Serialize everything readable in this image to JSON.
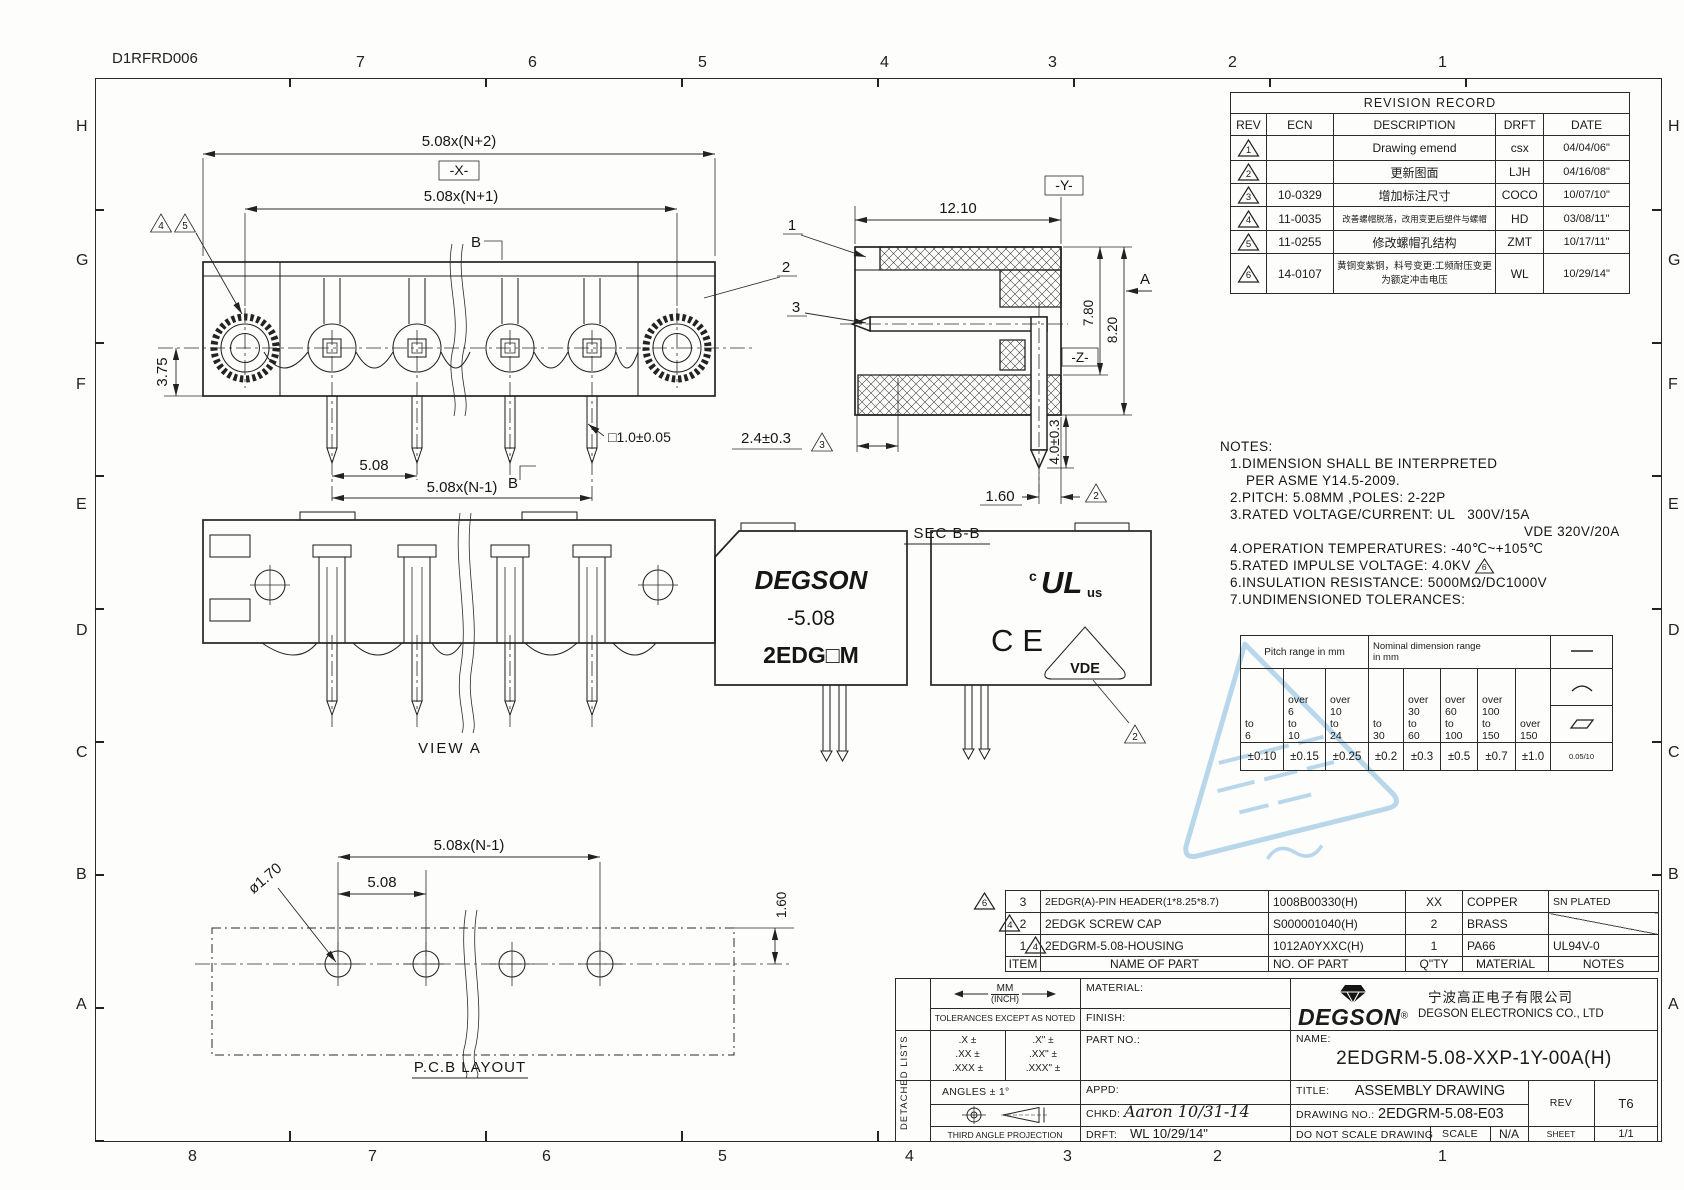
{
  "doc_code": "D1RFRD006",
  "grid": {
    "top": [
      "7",
      "6",
      "5",
      "4",
      "3",
      "2",
      "1"
    ],
    "bottom": [
      "8",
      "7",
      "6",
      "5",
      "4",
      "3",
      "2",
      "1"
    ],
    "left": [
      "H",
      "G",
      "F",
      "E",
      "D",
      "C",
      "B",
      "A"
    ],
    "right": [
      "H",
      "G",
      "F",
      "E",
      "D",
      "C",
      "B",
      "A"
    ]
  },
  "revision_table": {
    "title": "REVISION RECORD",
    "headers": {
      "rev": "REV",
      "ecn": "ECN",
      "description": "DESCRIPTION",
      "drft": "DRFT",
      "date": "DATE"
    },
    "rows": [
      {
        "rev": "1",
        "ecn": "",
        "desc": "Drawing emend",
        "drft": "csx",
        "date": "04/04/06\""
      },
      {
        "rev": "2",
        "ecn": "",
        "desc": "更新图面",
        "drft": "LJH",
        "date": "04/16/08\""
      },
      {
        "rev": "3",
        "ecn": "10-0329",
        "desc": "增加标注尺寸",
        "drft": "COCO",
        "date": "10/07/10\""
      },
      {
        "rev": "4",
        "ecn": "11-0035",
        "desc": "改善螺帽脱落，改用变更后塑件与螺帽",
        "drft": "HD",
        "date": "03/08/11\""
      },
      {
        "rev": "5",
        "ecn": "11-0255",
        "desc": "修改螺帽孔结构",
        "drft": "ZMT",
        "date": "10/17/11\""
      },
      {
        "rev": "6",
        "ecn": "14-0107",
        "desc": "黄铜变紫铜，料号变更:工频耐压变更为额定冲击电压",
        "drft": "WL",
        "date": "10/29/14\""
      }
    ]
  },
  "notes": {
    "title": "NOTES:",
    "line1": "1.DIMENSION SHALL BE INTERPRETED",
    "line1b": "PER ASME Y14.5-2009.",
    "line2": "2.PITCH: 5.08MM ,POLES: 2-22P",
    "line3": "3.RATED VOLTAGE/CURRENT: UL   300V/15A",
    "line3b": "VDE 320V/20A",
    "line4": "4.OPERATION TEMPERATURES: -40℃~+105℃",
    "line5": "5.RATED IMPULSE VOLTAGE: 4.0KV",
    "line5_flag": "6",
    "line6": "6.INSULATION RESISTANCE: 5000MΩ/DC1000V",
    "line7": "7.UNDIMENSIONED TOLERANCES:"
  },
  "tolerance_table": {
    "pitch_header": "Pitch range in mm",
    "nominal_header": "Nominal dimension range\nin mm",
    "ranges": [
      "to\n6",
      "over\n6\nto\n10",
      "over\n10\nto\n24",
      "to\n30",
      "over\n30\nto\n60",
      "over\n60\nto\n100",
      "over\n100\nto\n150",
      "over\n150"
    ],
    "values": [
      "±0.10",
      "±0.15",
      "±0.25",
      "±0.2",
      "±0.3",
      "±0.5",
      "±0.7",
      "±1.0"
    ],
    "flatness": "0.05/10",
    "symbols": [
      "straightness-line",
      "arc",
      "parallelogram"
    ]
  },
  "bom": {
    "headers": {
      "item": "ITEM",
      "name": "NAME OF PART",
      "part_no": "NO. OF  PART",
      "qty": "Q\"TY",
      "material": "MATERIAL",
      "notes": "NOTES"
    },
    "rows": [
      {
        "flag": "6",
        "item": "3",
        "name": "2EDGR(A)-PIN HEADER(1*8.25*8.7)",
        "part_no": "1008B00330(H)",
        "qty": "XX",
        "material": "COPPER",
        "notes": "SN PLATED"
      },
      {
        "flag": "4",
        "item": "2",
        "name": "2EDGK SCREW CAP",
        "part_no": "S000001040(H)",
        "qty": "2",
        "material": "BRASS",
        "notes": ""
      },
      {
        "flag": "4",
        "item": "1",
        "name": "2EDGRM-5.08-HOUSING",
        "part_no": "1012A0YXXC(H)",
        "qty": "1",
        "material": "PA66",
        "notes": "UL94V-0"
      }
    ]
  },
  "title_block": {
    "detached_lists": "DETACHED LISTS",
    "units_mm": "MM",
    "units_inch": "(INCH)",
    "tolerances_label": "TOLERANCES EXCEPT AS NOTED",
    "tol_mm": [
      ".X ±",
      ".XX ±",
      ".XXX ±"
    ],
    "tol_inch": [
      ".X\" ±",
      ".XX\" ±",
      ".XXX\" ±"
    ],
    "angles": "ANGLES ± 1°",
    "projection_label": "THIRD ANGLE PROJECTION",
    "material_label": "MATERIAL:",
    "finish_label": "FINISH:",
    "part_no_label": "PART NO.:",
    "appd_label": "APPD:",
    "chkd_label": "CHKD:",
    "chkd_value": "Aaron  10/31-14",
    "drft_label": "DRFT:",
    "drft_value": "WL  10/29/14\"",
    "brand": "DEGSON",
    "brand_reg": "®",
    "company_cn": "宁波高正电子有限公司",
    "company_en": "DEGSON ELECTRONICS CO., LTD",
    "name_label": "NAME:",
    "name_value": "2EDGRM-5.08-XXP-1Y-00A(H)",
    "title_label": "TITLE:",
    "title_value": "ASSEMBLY  DRAWING",
    "drawing_no_label": "DRAWING NO.:",
    "drawing_no_value": "2EDGRM-5.08-E03",
    "do_not_scale": "DO NOT SCALE DRAWING",
    "scale_label": "SCALE",
    "scale_value": "N/A",
    "sheet_label": "SHEET",
    "sheet_value": "1/1",
    "rev_label": "REV",
    "rev_value": "T6"
  },
  "views": {
    "top_view": {
      "dim_overall": "5.08x(N+2)",
      "datum_x": "-X-",
      "dim_screws": "5.08x(N+1)",
      "flag_a": "4",
      "flag_b": "5",
      "section": "B",
      "dim_height": "3.75",
      "dim_pitch": "5.08",
      "dim_span": "5.08x(N-1)",
      "dim_pin": "□1.0±0.05"
    },
    "section_bb": {
      "label": "SEC B-B",
      "dim_width": "12.10",
      "datum_y": "-Y-",
      "balloon_1": "1",
      "balloon_2": "2",
      "balloon_3": "3",
      "dim_h1": "7.80",
      "dim_h2": "8.20",
      "view_arrow": "A",
      "datum_z": "-Z-",
      "dim_front": "2.4±0.3",
      "flag_front": "3",
      "dim_pin_length": "4.0±0.3",
      "dim_pin_offset": "1.60",
      "flag_offset": "2"
    },
    "view_a": {
      "label": "VIEW A"
    },
    "marking_view": {
      "line1": "DEGSON",
      "line2": "-5.08",
      "line3": "2EDG□M"
    },
    "cert_view": {
      "ul_c": "c",
      "ul": "UL",
      "ul_us": "us",
      "ce": "CE",
      "vde": "VDE",
      "flag": "2"
    },
    "pcb_view": {
      "label": "P.C.B LAYOUT",
      "dim_span": "5.08x(N-1)",
      "dim_pitch": "5.08",
      "dim_hole": "ø1.70",
      "dim_edge": "1.60"
    }
  },
  "stamp_color": "#69abd6"
}
